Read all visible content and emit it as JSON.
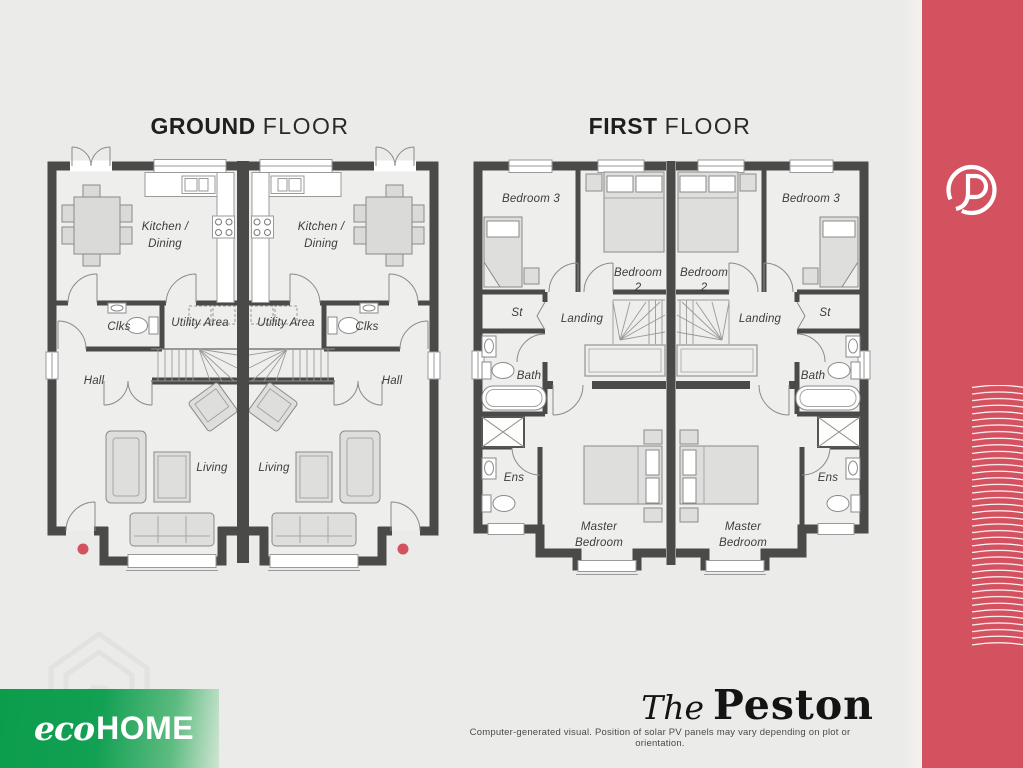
{
  "ground_floor": {
    "title_strong": "GROUND",
    "title_light": "FLOOR",
    "labels": {
      "kitchen_line1": "Kitchen /",
      "kitchen_line2": "Dining",
      "clks": "Clks",
      "utility": "Utility Area",
      "hall": "Hall",
      "living": "Living"
    }
  },
  "first_floor": {
    "title_strong": "FIRST",
    "title_light": "FLOOR",
    "labels": {
      "bedroom3": "Bedroom 3",
      "bedroom2_line1": "Bedroom",
      "bedroom2_line2": "2",
      "st": "St",
      "landing": "Landing",
      "bath": "Bath",
      "ens": "Ens",
      "master_line1": "Master",
      "master_line2": "Bedroom"
    }
  },
  "branding": {
    "eco": "eco",
    "home": "HOME",
    "house_name_prefix": "The",
    "house_name": "Peston",
    "logo_letter": "P",
    "disclaimer": "Computer-generated visual. Position of solar PV panels may vary depending on plot or orientation."
  },
  "colors": {
    "accent_red": "#D4515F",
    "brand_green": "#0B9D4C",
    "wall": "#4A4A48",
    "background": "#EBEBE9"
  }
}
